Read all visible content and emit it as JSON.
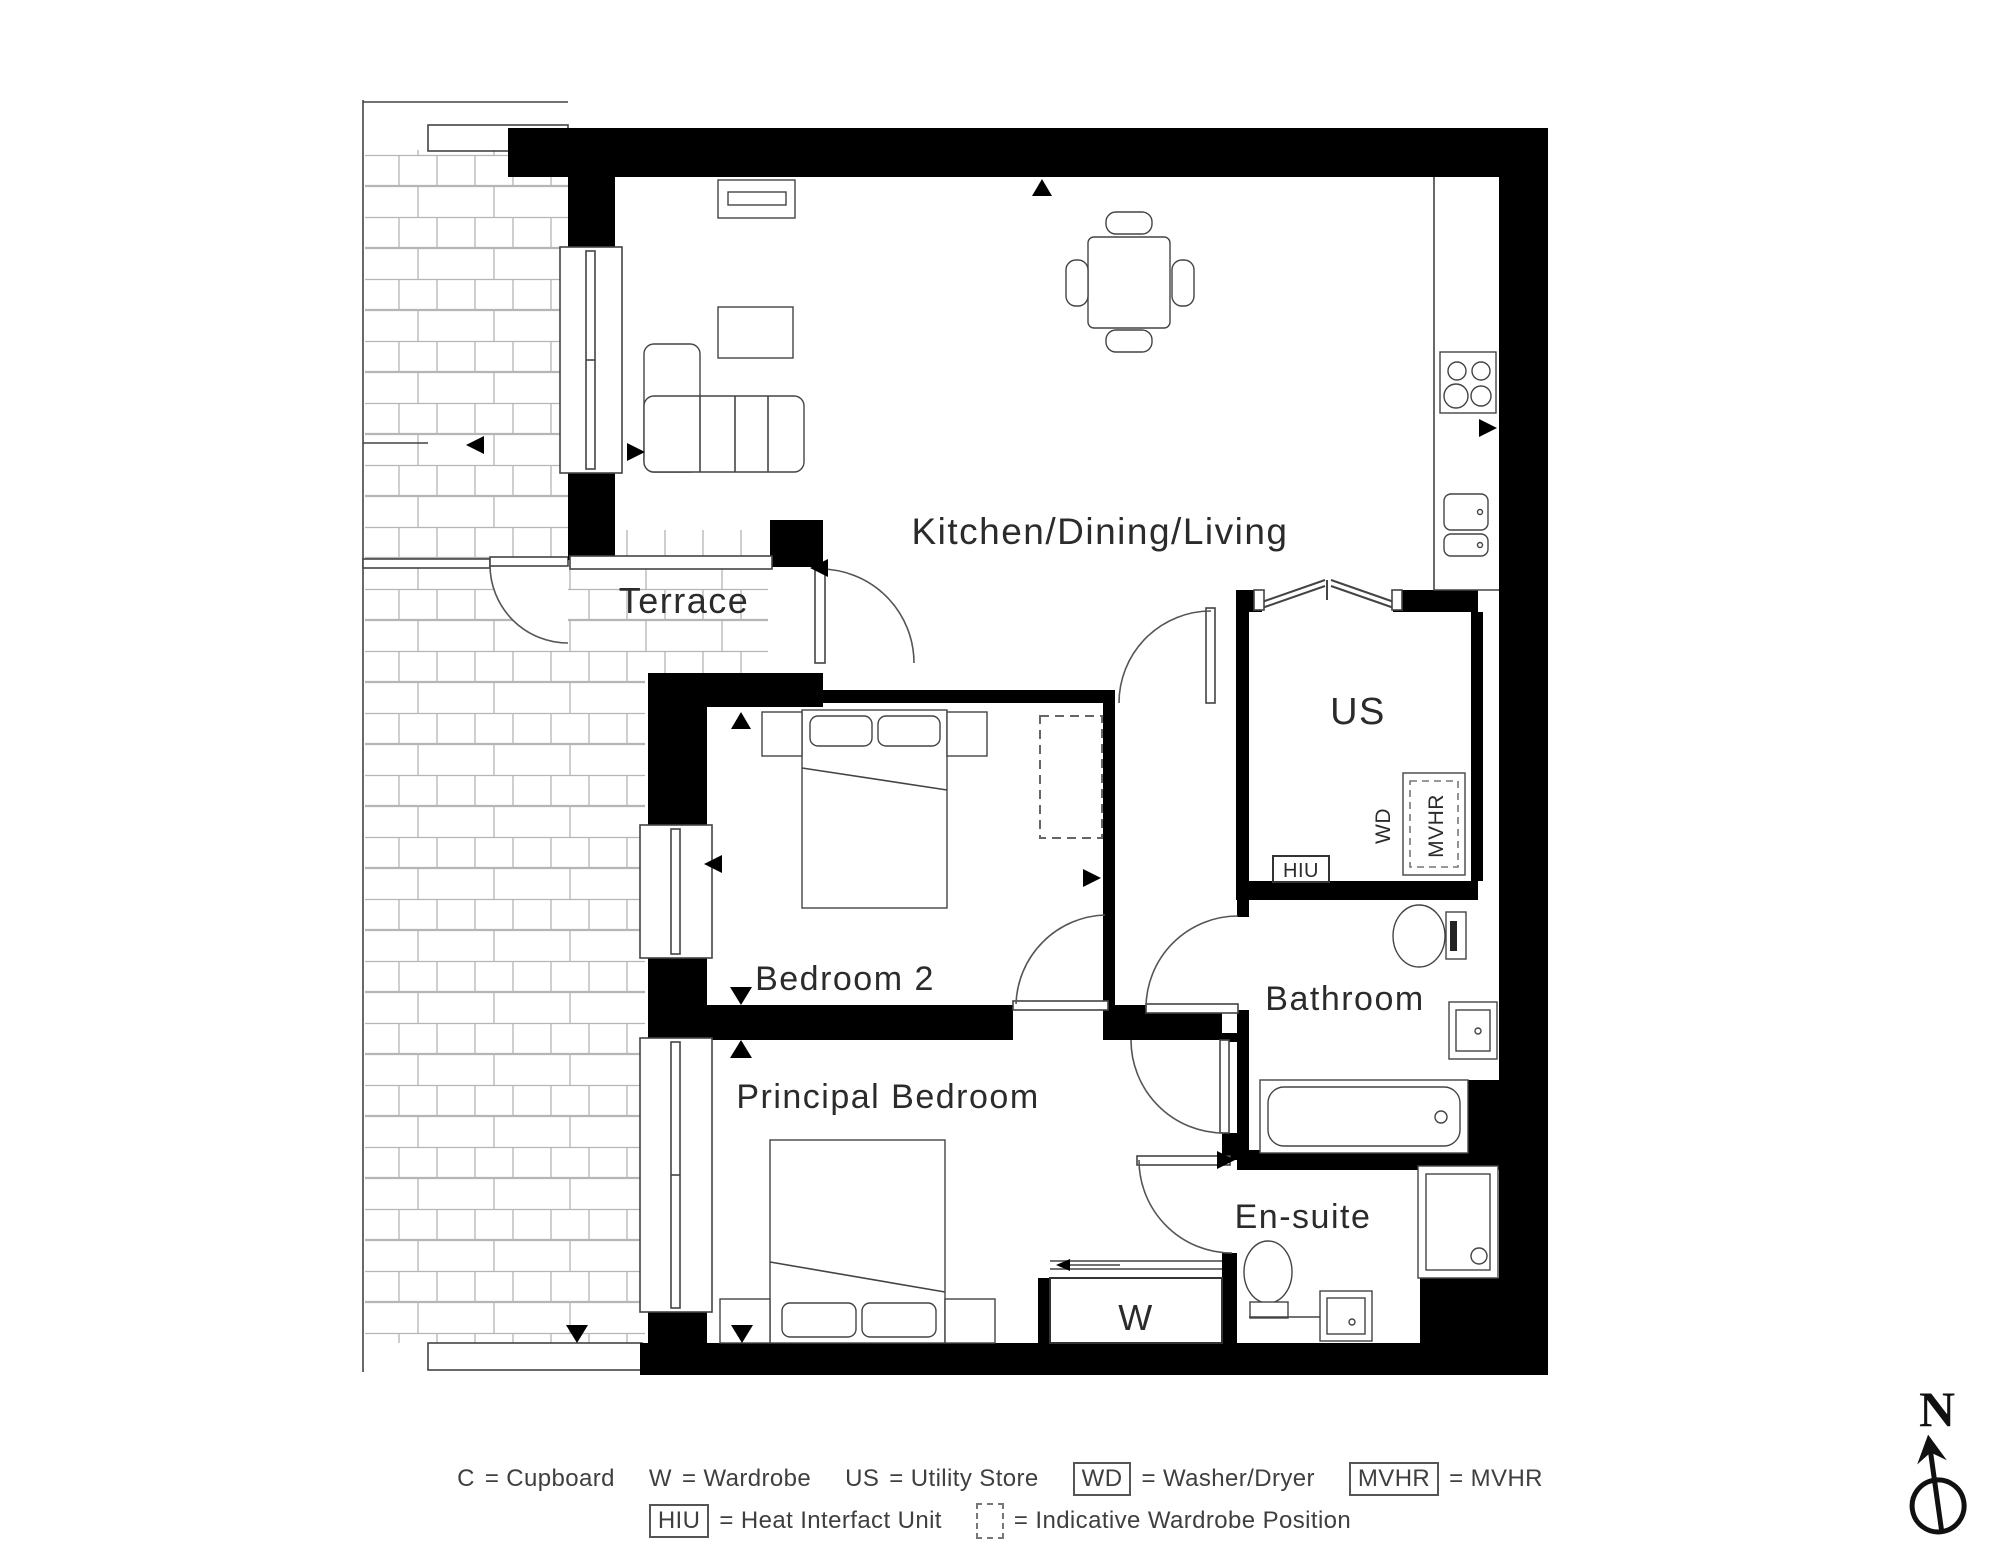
{
  "rooms": {
    "kitchen_dining_living": "Kitchen/Dining/Living",
    "terrace": "Terrace",
    "bedroom2": "Bedroom 2",
    "principal_bedroom": "Principal Bedroom",
    "bathroom": "Bathroom",
    "ensuite": "En-suite",
    "utility_store": "US",
    "wardrobe": "W"
  },
  "labels": {
    "wd": "WD",
    "mvhr": "MVHR",
    "hiu": "HIU"
  },
  "legend": {
    "cupboard_key": "C",
    "cupboard": "= Cupboard",
    "wardrobe_key": "W",
    "wardrobe": "= Wardrobe",
    "utility_key": "US",
    "utility": "= Utility Store",
    "wd_key": "WD",
    "wd": "= Washer/Dryer",
    "mvhr_key": "MVHR",
    "mvhr": "= MVHR",
    "hiu_key": "HIU",
    "hiu": "= Heat Interfact Unit",
    "iwp": "= Indicative Wardrobe Position"
  },
  "compass": {
    "north": "N"
  },
  "colors": {
    "wall": "#000000",
    "line": "#444444",
    "brick_line": "#b5b5b5",
    "text": "#2b2b2b"
  }
}
